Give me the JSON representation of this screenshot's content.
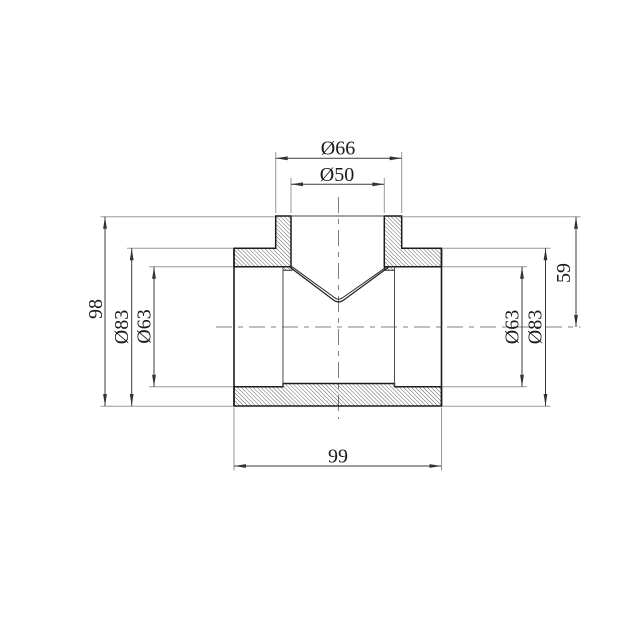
{
  "drawing": {
    "kind": "technical-drawing",
    "subject": "pipe tee fitting section view",
    "background": "#ffffff",
    "colors": {
      "outline": "#1c1c1c",
      "dimension_line": "#3a3a3a",
      "extension_line": "#9a9a9a",
      "centerline": "#7f7f7f",
      "hatch": "#2d2d2d",
      "text": "#1a1a1a"
    },
    "dimensions": {
      "top": [
        {
          "id": "outer-top-port-diameter",
          "label": "Ø66"
        },
        {
          "id": "inner-top-port-diameter",
          "label": "Ø50"
        }
      ],
      "left": [
        {
          "id": "overall-height",
          "label": "98"
        },
        {
          "id": "outer-body-diameter-left",
          "label": "Ø83"
        },
        {
          "id": "inner-bore-diameter-left",
          "label": "Ø63"
        }
      ],
      "right": [
        {
          "id": "inner-bore-diameter-right",
          "label": "Ø63"
        },
        {
          "id": "outer-body-diameter-right",
          "label": "Ø83"
        },
        {
          "id": "top-to-axis-height",
          "label": "59"
        }
      ],
      "bottom": [
        {
          "id": "body-length",
          "label": "99"
        }
      ]
    }
  }
}
